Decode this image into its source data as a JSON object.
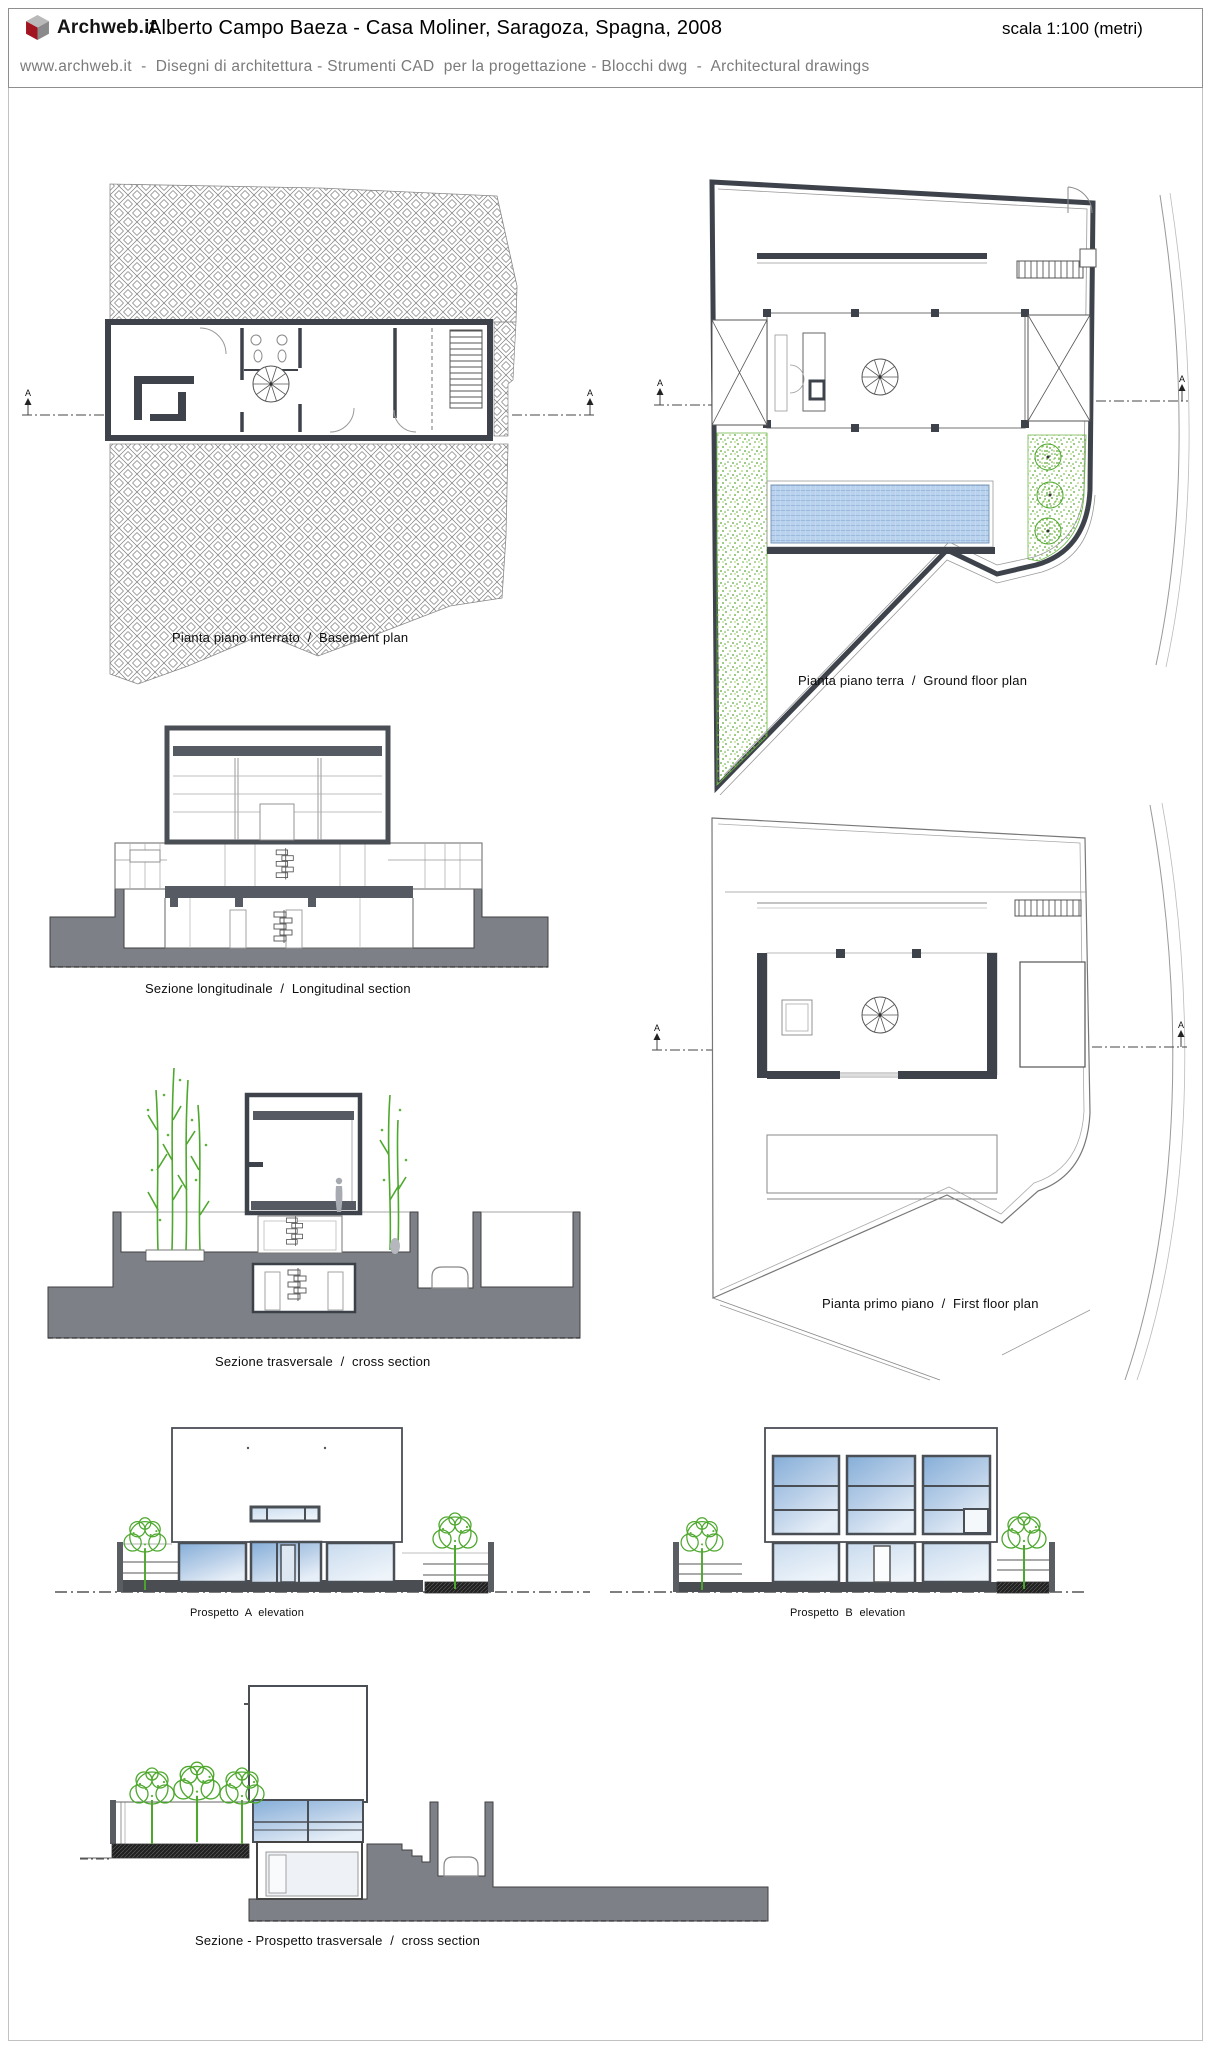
{
  "header": {
    "logo_text": "Archweb.it",
    "title": "Alberto Campo Baeza - Casa Moliner, Saragoza, Spagna, 2008",
    "scale_note": "scala 1:100 (metri)",
    "subtitle": "www.archweb.it  -  Disegni di architettura - Strumenti CAD  per la progettazione - Blocchi dwg  -  Architectural drawings"
  },
  "figures": [
    {
      "id": "basement-plan",
      "caption": "Pianta piano interrato  /  Basement plan"
    },
    {
      "id": "ground-floor-plan",
      "caption": "Pianta piano terra  /  Ground floor plan"
    },
    {
      "id": "longitudinal-section",
      "caption": "Sezione longitudinale  /  Longitudinal section"
    },
    {
      "id": "first-floor-plan",
      "caption": "Pianta primo piano  /  First floor plan"
    },
    {
      "id": "cross-section",
      "caption": "Sezione trasversale  /  cross section"
    },
    {
      "id": "elevation-a",
      "caption": "Prospetto  A  elevation"
    },
    {
      "id": "elevation-b",
      "caption": "Prospetto  B  elevation"
    },
    {
      "id": "section-elevation",
      "caption": "Sezione - Prospetto trasversale  /  cross section"
    }
  ],
  "section_marker_label": "A",
  "colors": {
    "wall_dark": "#3e434b",
    "poche_gray": "#7d8187",
    "pool_blue": "#b9d2ee",
    "window_blue": "#85aed8",
    "tree_green": "#4ea82e",
    "logo_red": "#a21420",
    "header_border": "#8f8f8f",
    "subtitle_gray": "#7b7b7b"
  }
}
